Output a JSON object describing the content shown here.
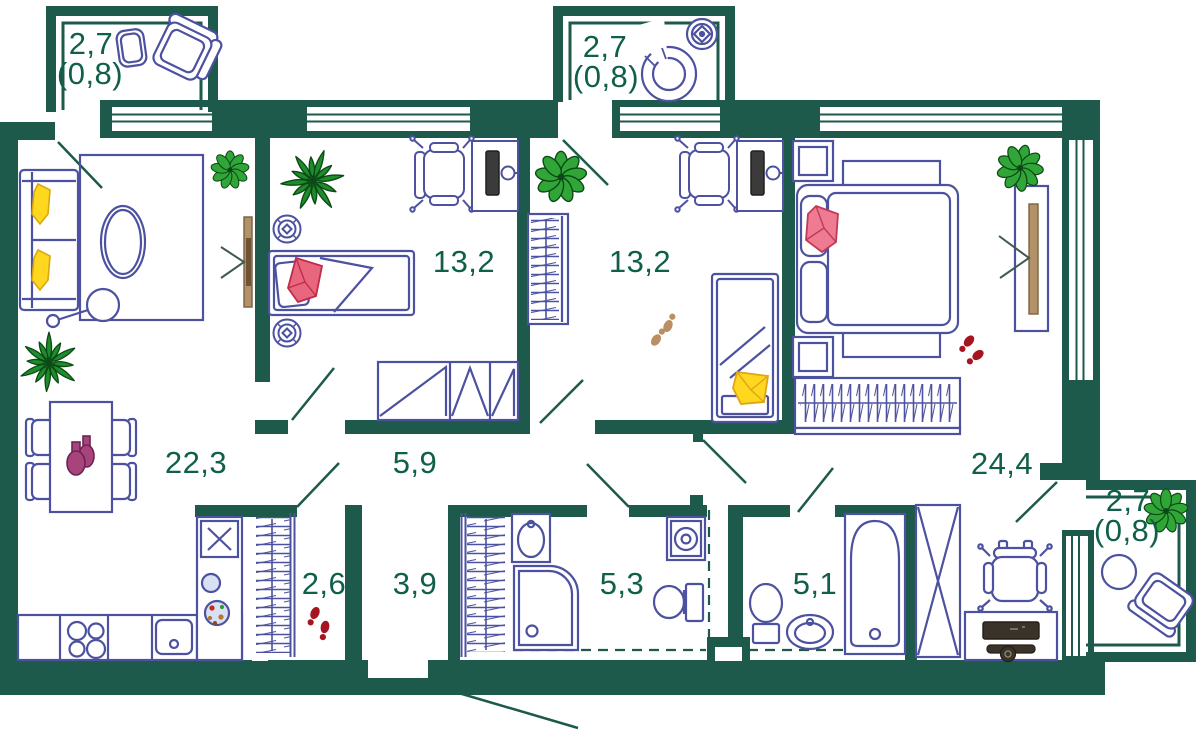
{
  "plan_type": "apartment-floor-plan",
  "rooms": {
    "living_kitchen": {
      "area": "22,3"
    },
    "hall": {
      "area": "5,9"
    },
    "bedroom1": {
      "area": "13,2"
    },
    "bedroom2": {
      "area": "13,2"
    },
    "master": {
      "area": "24,4"
    },
    "wardrobe_hall": {
      "area": "2,6"
    },
    "entry_hall": {
      "area": "3,9"
    },
    "bathroom1": {
      "area": "5,3"
    },
    "bathroom2": {
      "area": "5,1"
    },
    "balcony_tl": {
      "area": "2,7",
      "coef": "(0,8)"
    },
    "balcony_tm": {
      "area": "2,7",
      "coef": "(0,8)"
    },
    "balcony_r": {
      "area": "2,7",
      "coef": "(0,8)"
    }
  },
  "colors": {
    "wall": "#1d5a4c",
    "furniture": "#4c51a0",
    "label": "#0f5f4a",
    "plant_round": "#2fa637",
    "plant_spiky": "#1e8c2a",
    "accent_yellow": "#ffd71e",
    "accent_pink": "#ee7b92",
    "accent_red": "#a61420",
    "accent_beige": "#bb8f63",
    "accent_purple": "#a8447c",
    "wood": "#b3926a"
  }
}
